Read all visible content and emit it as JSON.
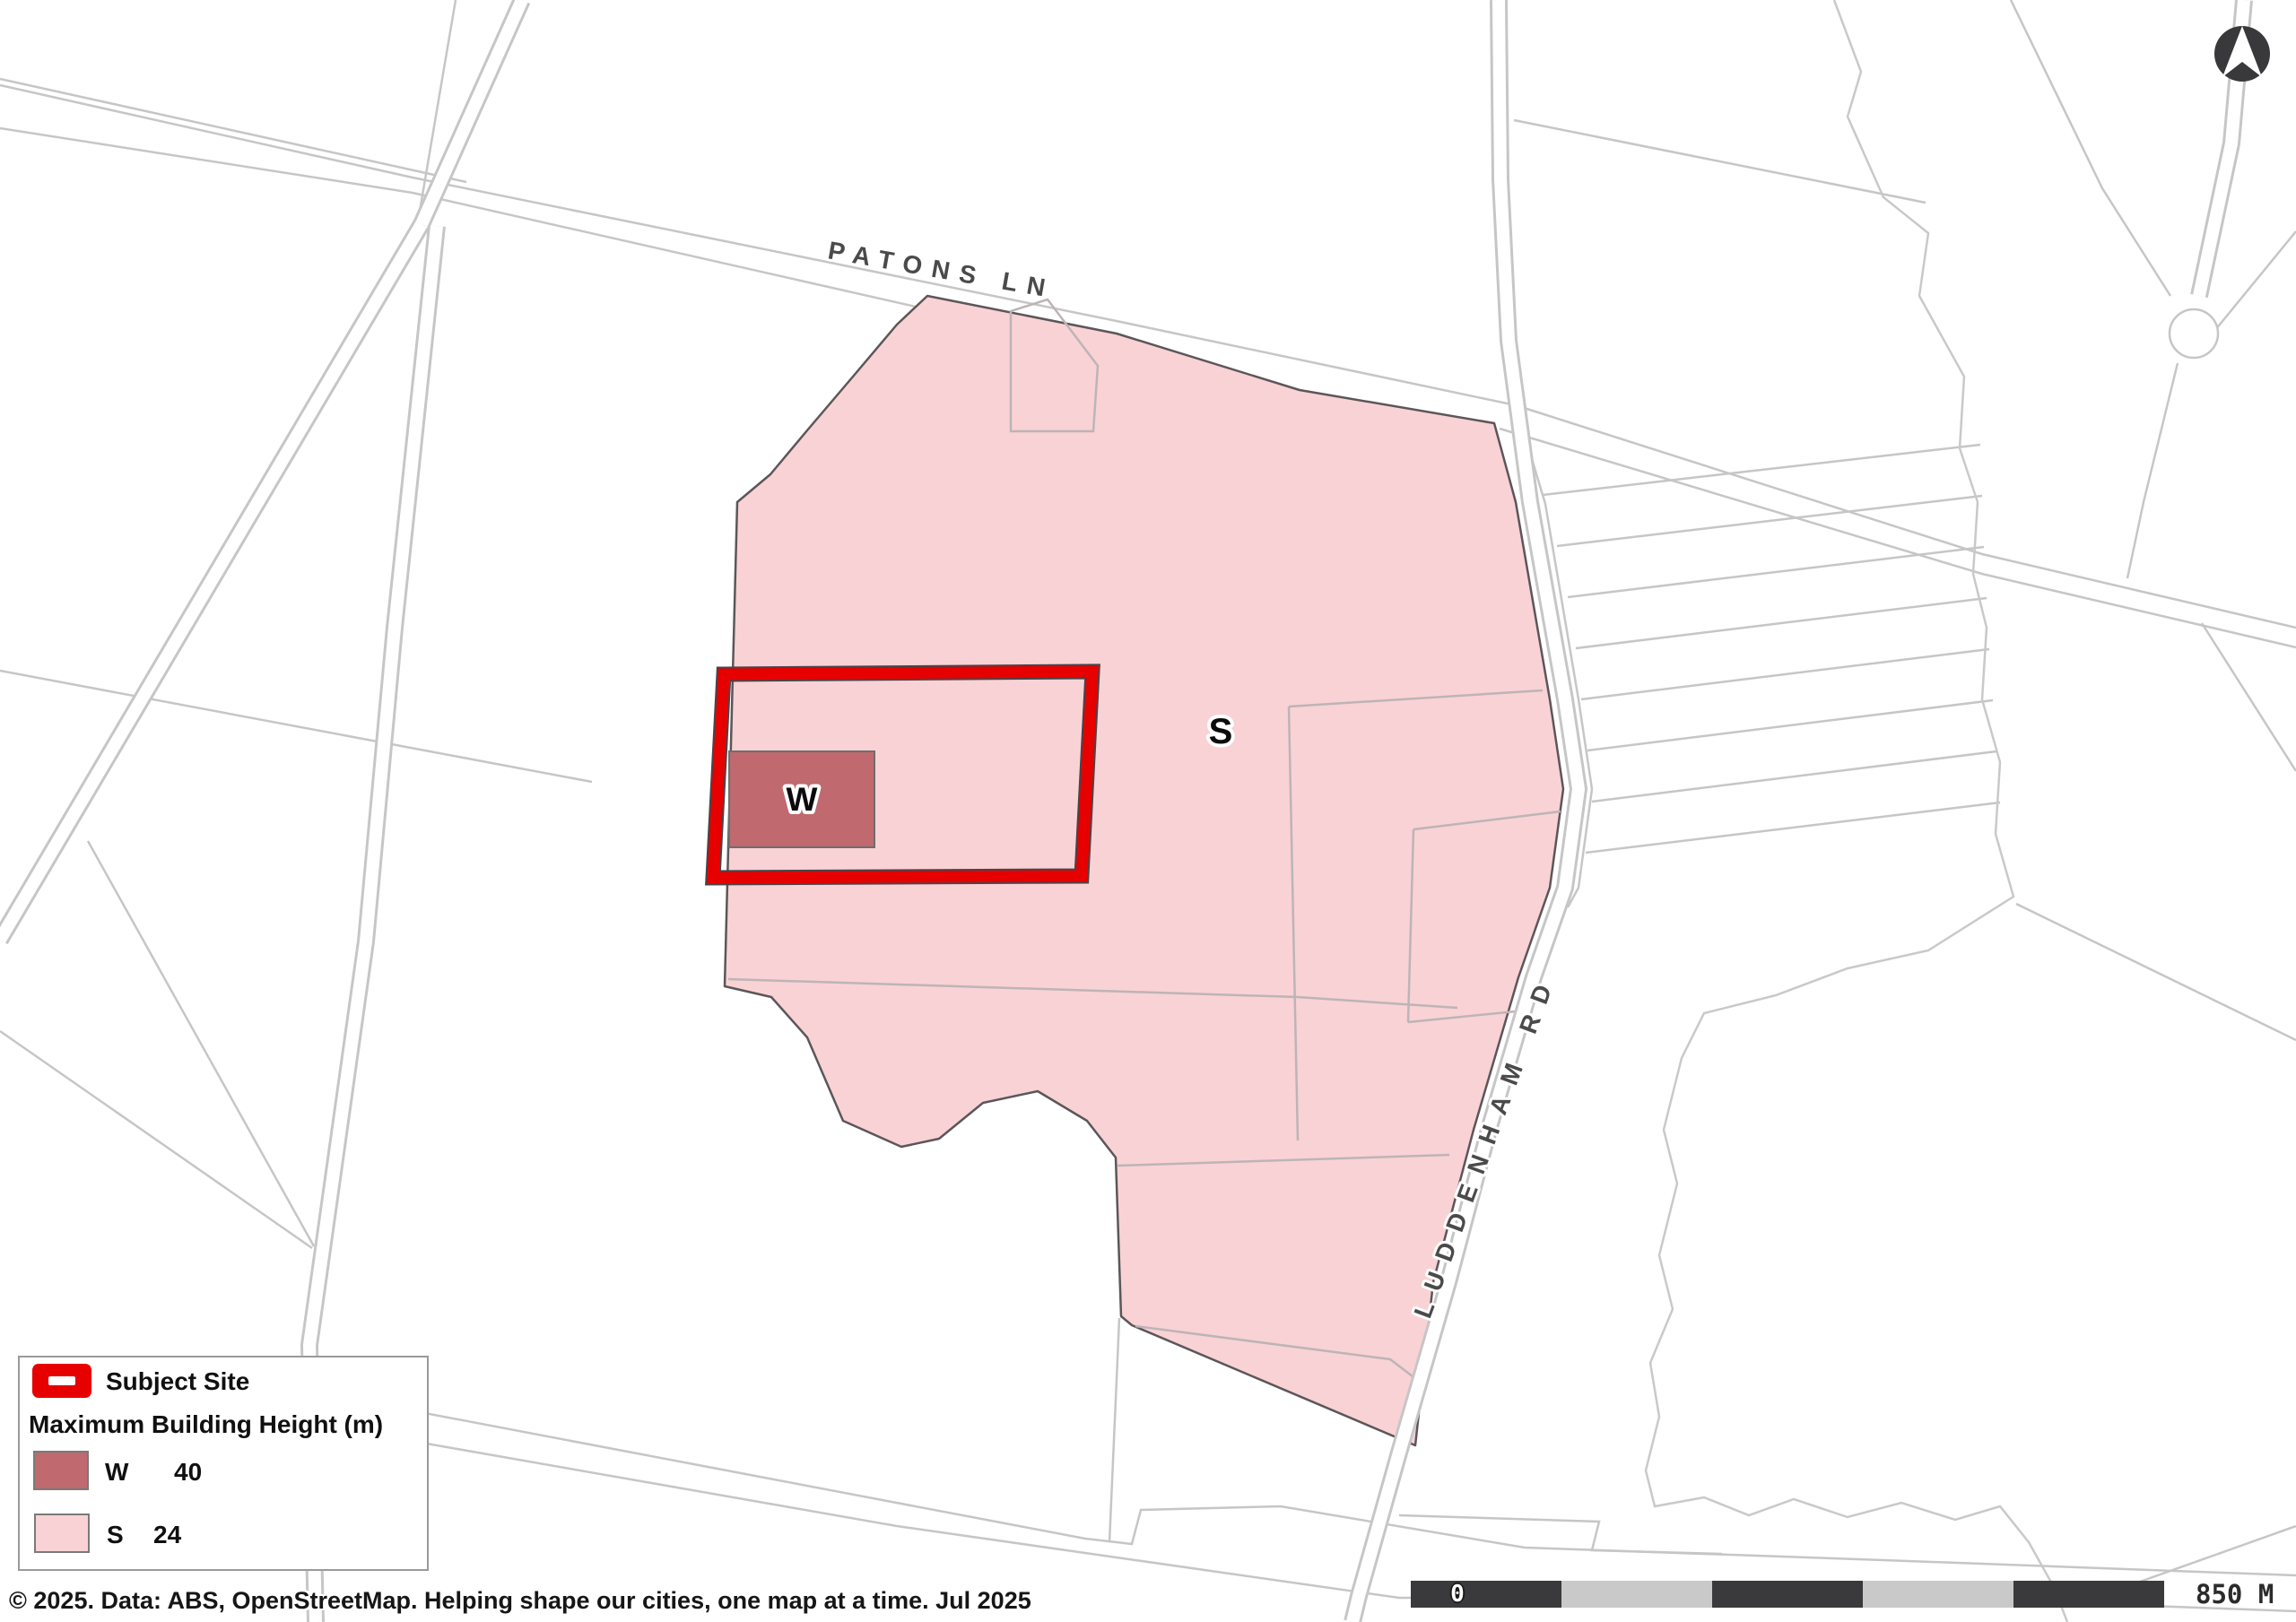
{
  "map": {
    "road_labels": {
      "patons_ln": "PATONS LN",
      "luddenham_rd": "LUDDENHAM RD"
    },
    "zone_labels": {
      "s": "S",
      "w": "W"
    },
    "colors": {
      "zone_s_fill": "#F9D2D5",
      "zone_w_fill": "#C0696E",
      "subject_site_outline": "#E60000",
      "zone_boundary": "#5B565A",
      "parcel_line": "#C6C6C6",
      "road_label_text": "#4A4A4A"
    }
  },
  "legend": {
    "subject_site_label": "Subject Site",
    "section_title": "Maximum Building Height (m)",
    "items": [
      {
        "code": "W",
        "value": "40",
        "color": "#C0696E"
      },
      {
        "code": "S",
        "value": "24",
        "color": "#F9D2D5"
      }
    ]
  },
  "scale_bar": {
    "start_label": "0",
    "end_label": "850 M",
    "segment_count": 5,
    "dark_color": "#3A3A3C",
    "light_color": "#C9C9C9"
  },
  "footer": {
    "copyright": "© 2025. Data: ABS, OpenStreetMap. Helping shape our cities, one map at a time. Jul 2025"
  },
  "compass": {
    "name": "north-arrow"
  }
}
